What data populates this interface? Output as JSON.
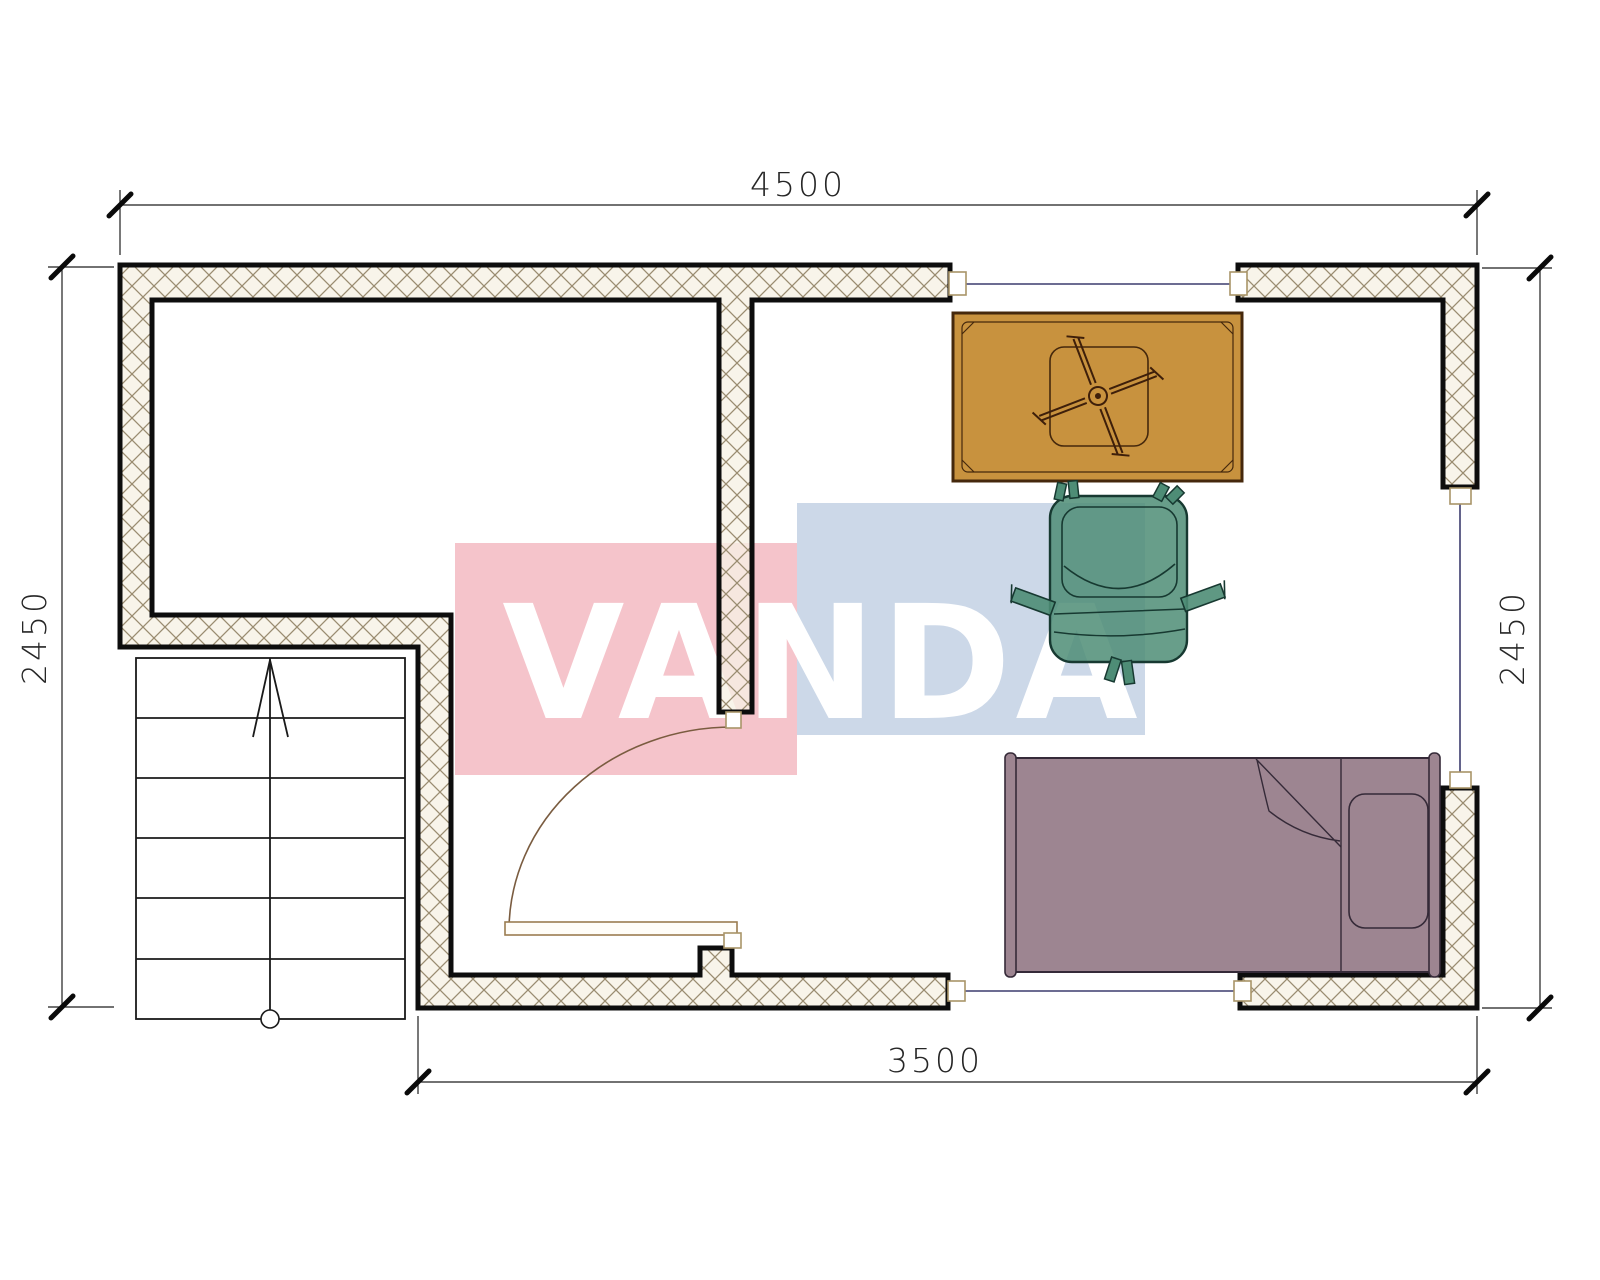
{
  "watermark": {
    "text": "VANDA",
    "red_block_color": "#f5c4cb",
    "blue_block_color": "#ccd8e8",
    "text_color": "#ffffff"
  },
  "dimensions": {
    "top": "4500",
    "bottom": "3500",
    "left": "2450",
    "right": "2450"
  },
  "plan": {
    "wall_fill": "#f6f1e4",
    "hatch_color": "#9a8c70",
    "wall_outline_color": "#0d0d0d",
    "dimension_color": "#262626",
    "window_sill_color": "#3c3c6e",
    "door_color": "#7a5c40",
    "stairs_color": "#1a1a1a"
  },
  "furniture": {
    "table": {
      "name": "kotatsu-table",
      "fill": "#c8923e",
      "outline": "#45280c"
    },
    "chair": {
      "name": "floor-chair",
      "fill": "#4e8d76",
      "outline": "#173931"
    },
    "bed": {
      "name": "single-bed",
      "fill": "#9d8591",
      "outline": "#352a38"
    }
  }
}
